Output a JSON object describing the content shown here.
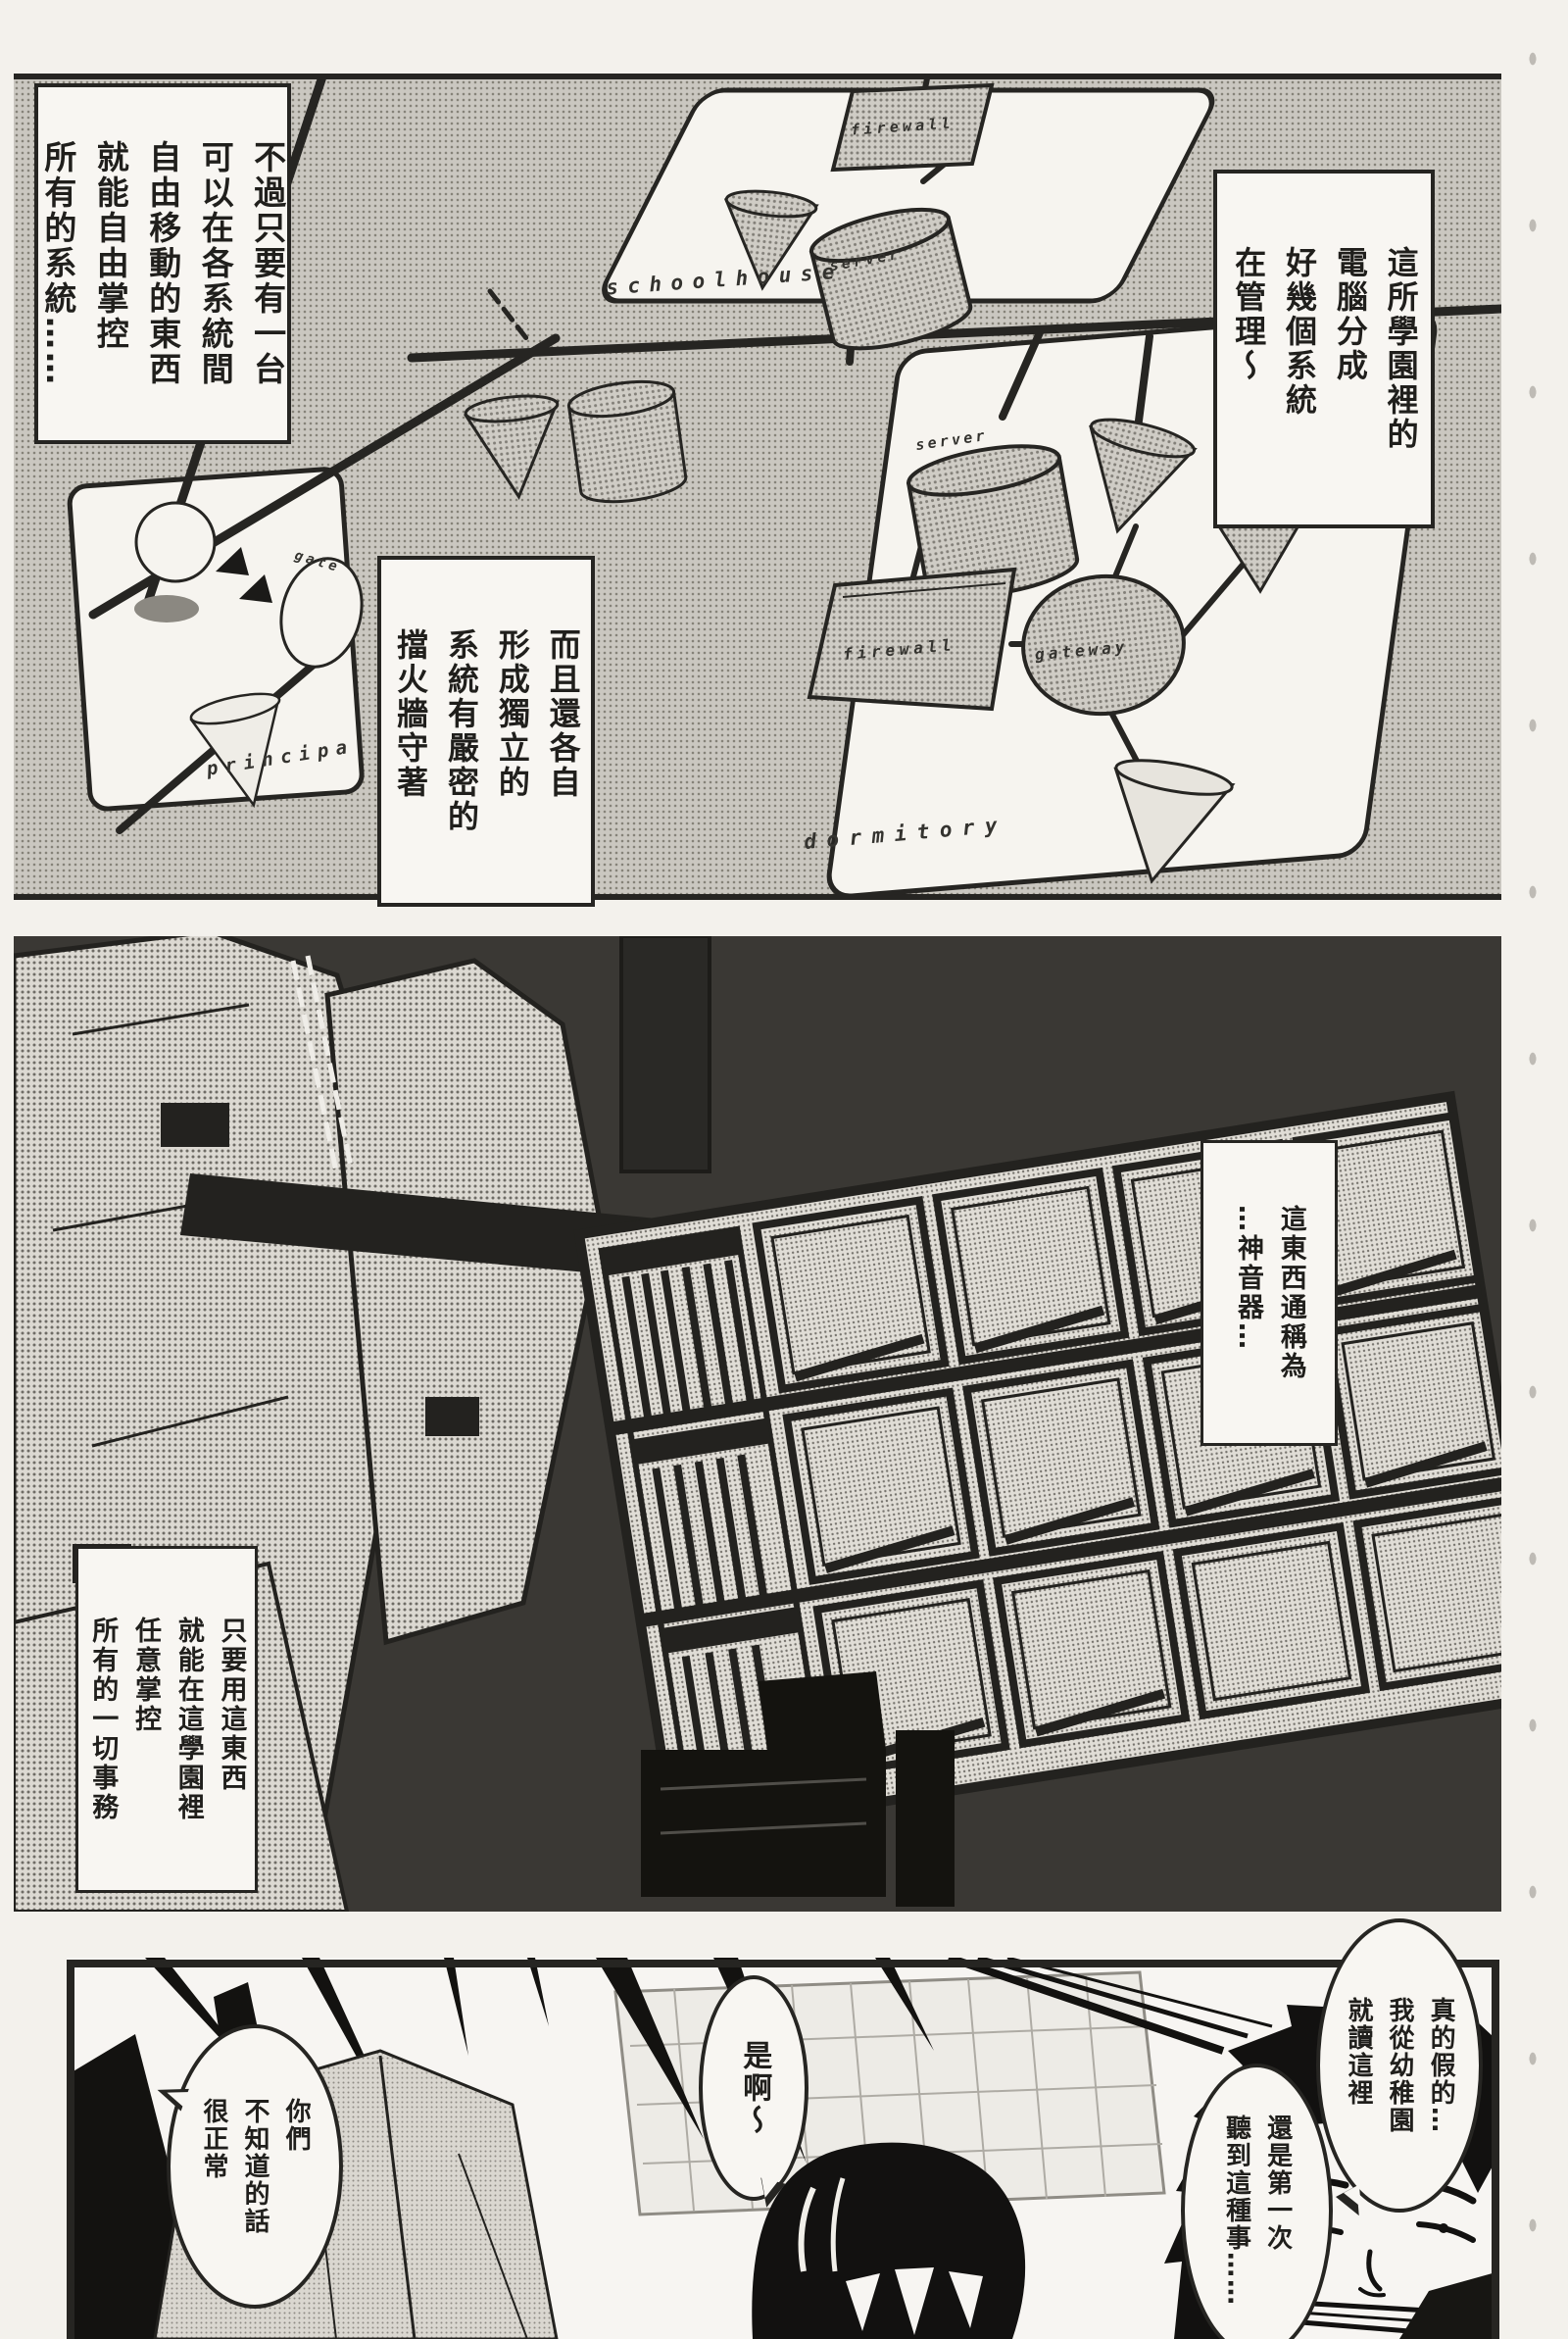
{
  "page": {
    "kind": "manga page"
  },
  "colors": {
    "ink": "#262522",
    "paper": "#f3f1ec",
    "tone": "#cac7c0"
  },
  "panel1": {
    "captions": {
      "only_need_one": "不過只要有一台\n可以在各系統間\n自由移動的東西\n就能自由掌控\n所有的系統……",
      "systems_managed": "這所學園裡的\n電腦分成\n好幾個系統\n在管理～",
      "firewalled": "而且還各自\n形成獨立的\n系統有嚴密的\n擋火牆守著"
    },
    "diagram": {
      "schoolhouse": {
        "board_label": "schoolhouse",
        "firewall": "firewall",
        "server": "server"
      },
      "principal": {
        "board_label": "principa",
        "gateway": "gate"
      },
      "dormitory": {
        "board_label": "dormitory",
        "server": "server",
        "firewall": "firewall",
        "gateway": "gateway"
      }
    }
  },
  "panel2": {
    "captions": {
      "called_device": "這東西通稱為\n…神音器…",
      "control_everything": "只要用這東西\n就能在這學園裡\n任意掌控\n所有的一切事務"
    }
  },
  "panel3": {
    "bubbles": {
      "really": "真的假的…\n我從幼稚園\n就讀這裡",
      "first_time": "還是第一次\n聽到這種事……",
      "yeah": "是啊～",
      "normal": "你們\n不知道的話\n很正常"
    }
  }
}
